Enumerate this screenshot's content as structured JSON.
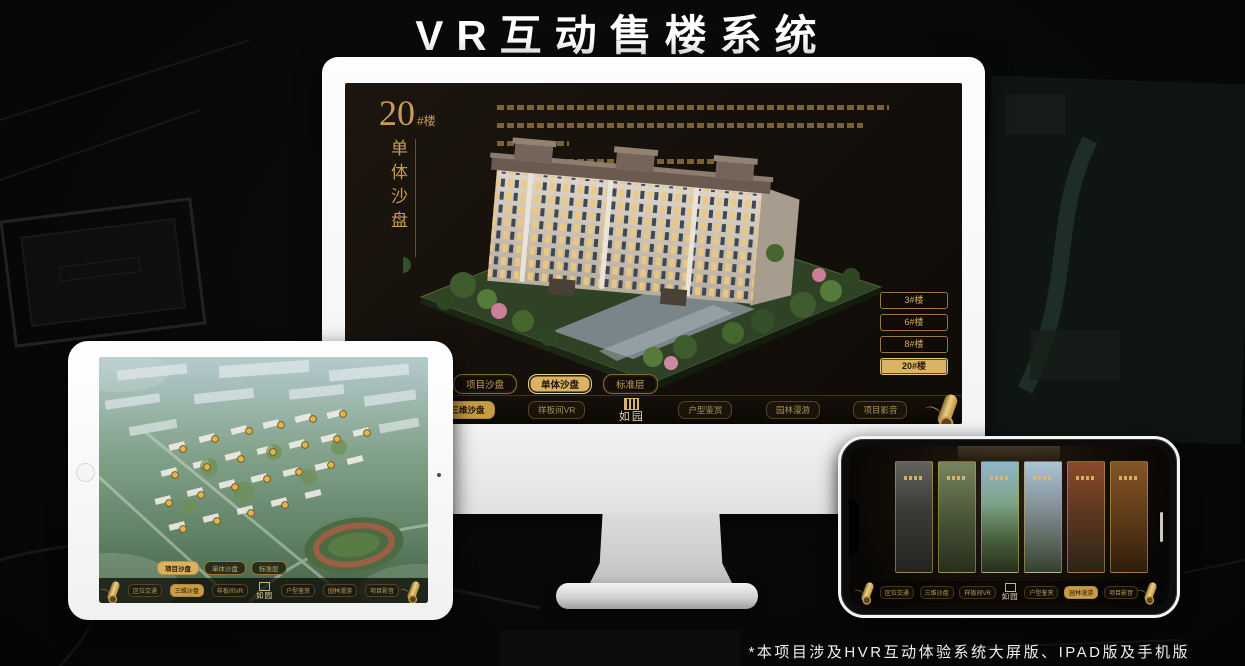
{
  "title": "VR互动售楼系统",
  "footnote": "*本项目涉及HVR互动体验系统大屏版、IPAD版及手机版",
  "brand": {
    "logo": "如园"
  },
  "colors": {
    "gold": "#c9a25c",
    "gold_active": "#d9b365",
    "screen_bg": "#17110b",
    "title_color": "#ffffff"
  },
  "monitor": {
    "heading": {
      "number": "20",
      "unit": "#楼",
      "subtitle": "单体沙盘"
    },
    "building_buttons": [
      {
        "label": "3#楼",
        "active": false
      },
      {
        "label": "6#楼",
        "active": false
      },
      {
        "label": "8#楼",
        "active": false
      },
      {
        "label": "20#楼",
        "active": true
      }
    ],
    "tabs": [
      {
        "label": "项目沙盘",
        "active": false
      },
      {
        "label": "单体沙盘",
        "active": true
      },
      {
        "label": "标准层",
        "active": false
      }
    ],
    "menu": [
      {
        "label": "区位交通",
        "active": false
      },
      {
        "label": "三维沙盘",
        "active": true
      },
      {
        "label": "样板间VR",
        "active": false
      },
      {
        "label": "户型鉴赏",
        "active": false
      },
      {
        "label": "园林漫游",
        "active": false
      },
      {
        "label": "项目影音",
        "active": false
      }
    ]
  },
  "ipad": {
    "tabs": [
      {
        "label": "项目沙盘",
        "active": true
      },
      {
        "label": "单体沙盘",
        "active": false
      },
      {
        "label": "标准层",
        "active": false
      }
    ],
    "menu": [
      {
        "label": "区位交通",
        "active": false
      },
      {
        "label": "三维沙盘",
        "active": true
      },
      {
        "label": "样板间VR",
        "active": false
      },
      {
        "label": "户型鉴赏",
        "active": false
      },
      {
        "label": "园林漫游",
        "active": false
      },
      {
        "label": "项目影音",
        "active": false
      }
    ]
  },
  "phone": {
    "menu": [
      {
        "label": "区位交通",
        "active": false
      },
      {
        "label": "三维沙盘",
        "active": false
      },
      {
        "label": "样板间VR",
        "active": false
      },
      {
        "label": "户型鉴赏",
        "active": false
      },
      {
        "label": "园林漫游",
        "active": true
      },
      {
        "label": "项目影音",
        "active": false
      }
    ],
    "gallery_panels": 6
  }
}
